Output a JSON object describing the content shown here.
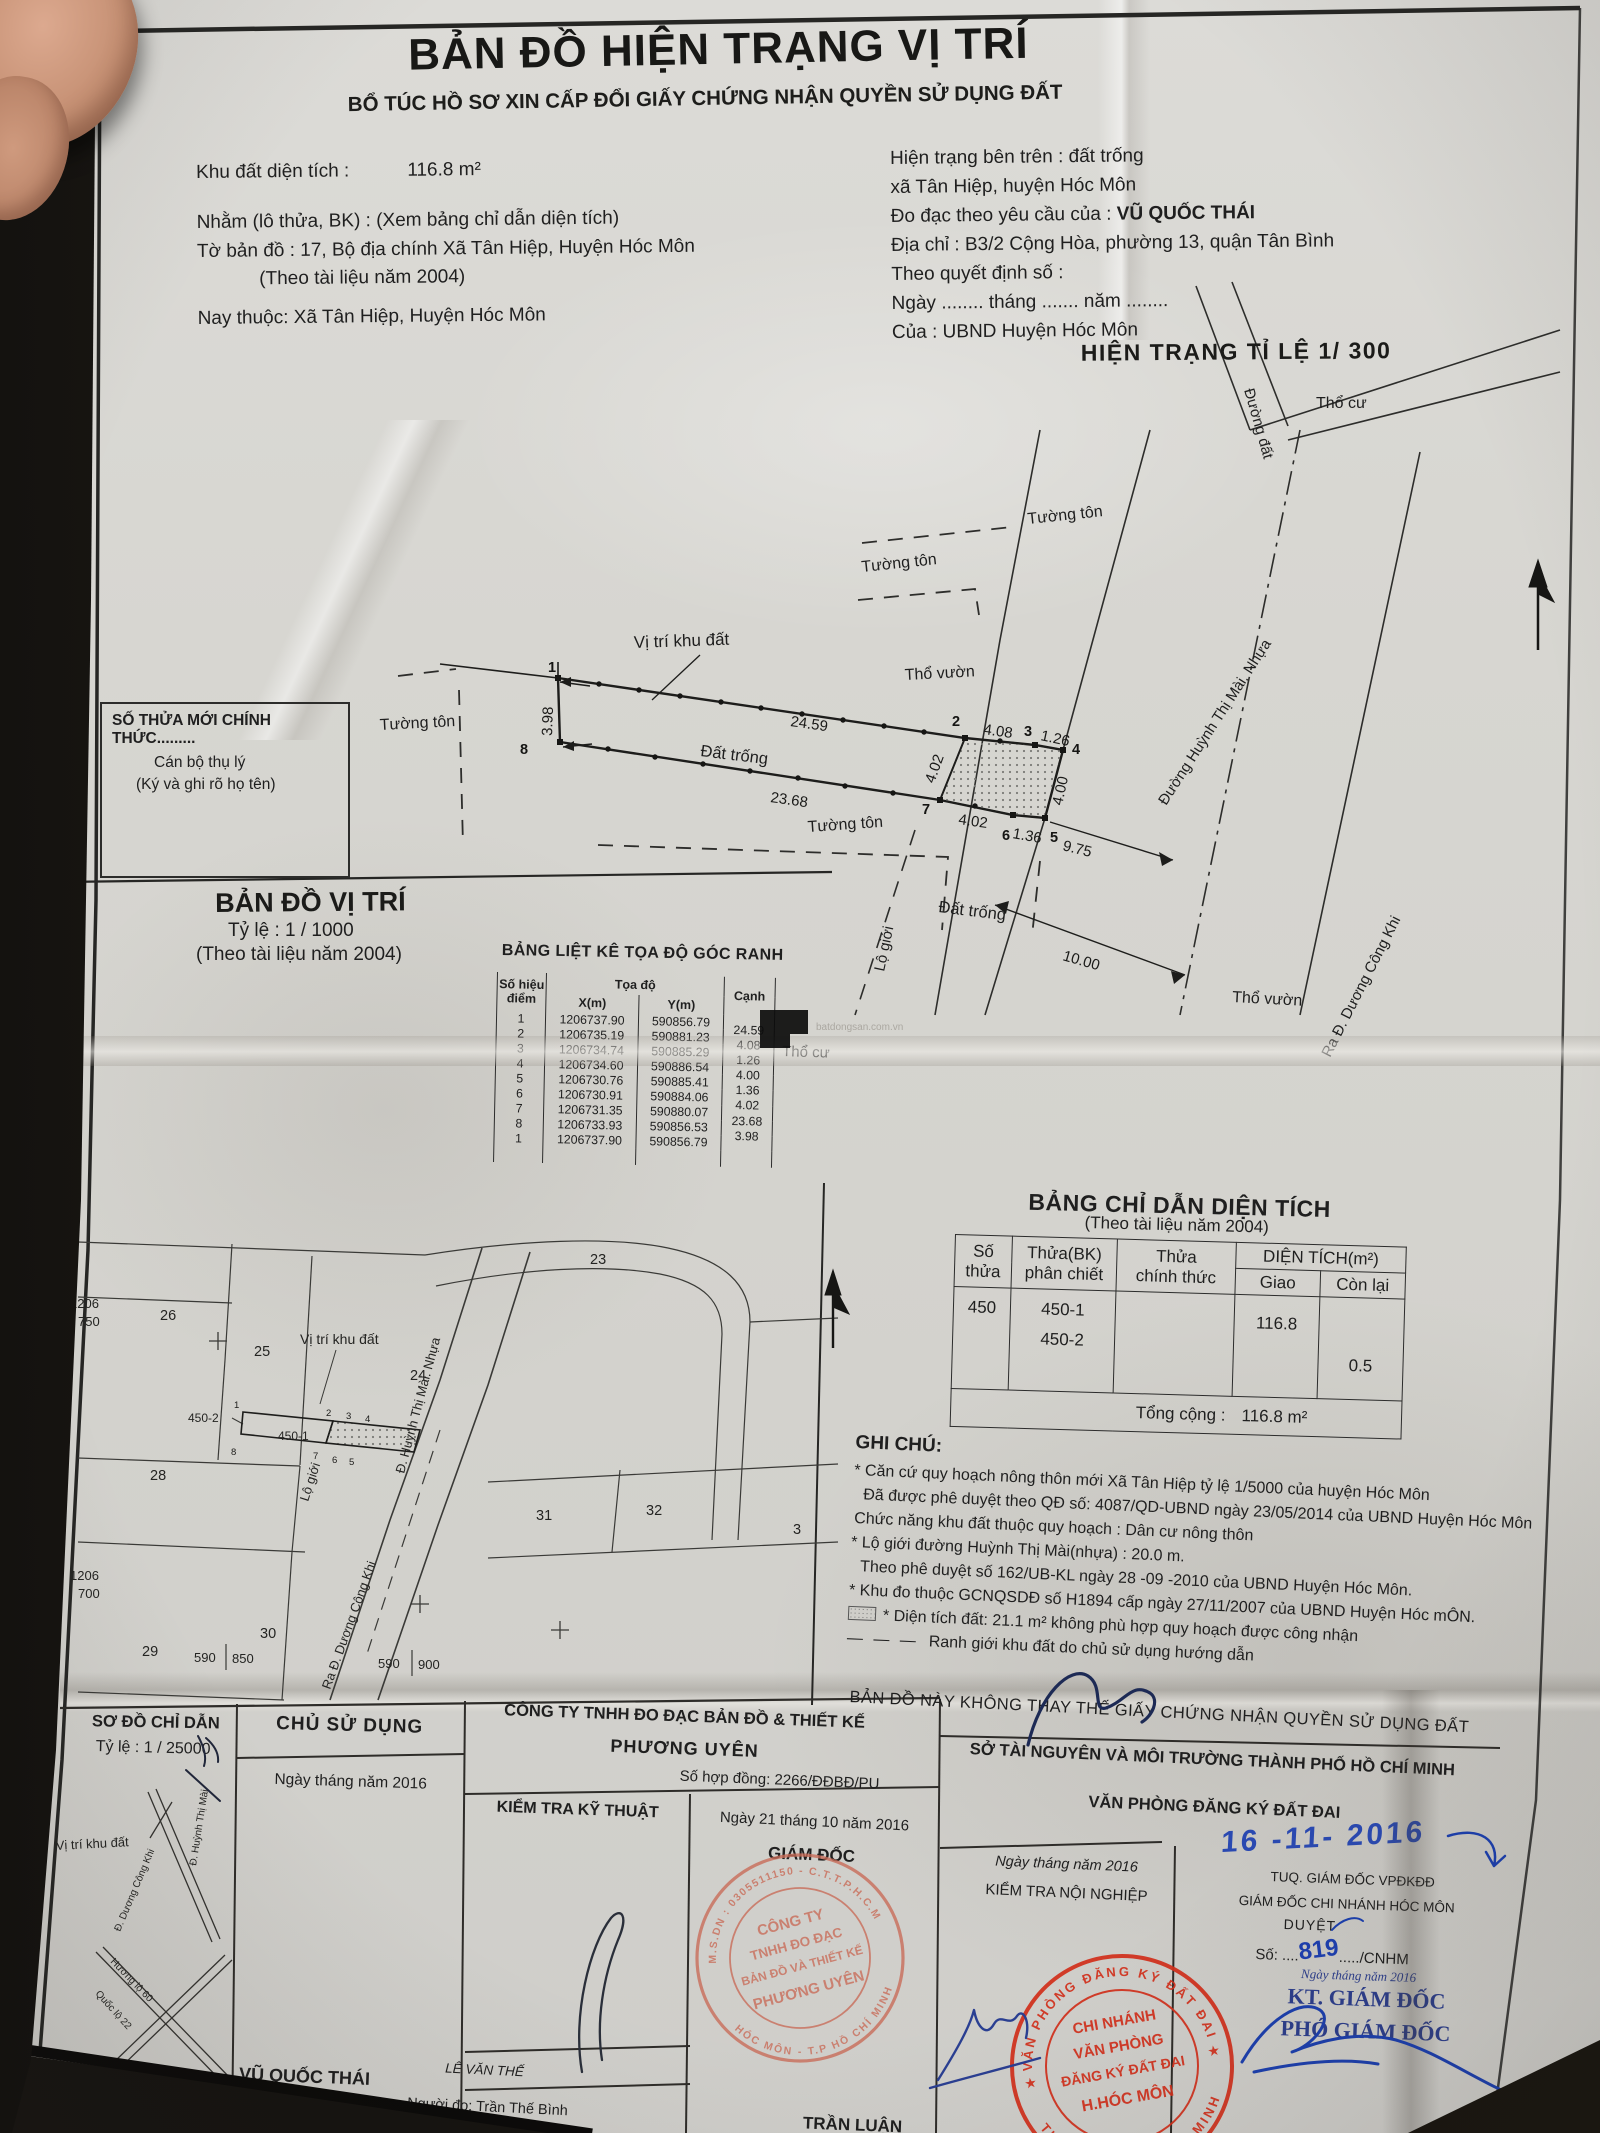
{
  "watermark": "batdongsan.com.vn",
  "header": {
    "title": "BẢN ĐỒ HIỆN TRẠNG VỊ TRÍ",
    "subtitle": "BỔ TÚC HỒ SƠ XIN CẤP ĐỔI GIẤY CHỨNG NHẬN QUYỀN SỬ DỤNG ĐẤT"
  },
  "info_left": {
    "area_label": "Khu đất diện tích :",
    "area_value": "116.8 m²",
    "lot_line": "Nhằm (lô thửa, BK) :  (Xem bảng chỉ dẫn diện tích)",
    "sheet_line": "Tờ bản đồ :  17, Bộ địa chính Xã Tân Hiệp, Huyện Hóc Môn",
    "doc_year": "(Theo tài liệu năm 2004)",
    "now_line": "Nay thuộc:  Xã Tân Hiệp, Huyện Hóc Môn"
  },
  "info_right": {
    "surface": "Hiện trạng bên trên : đất trống",
    "commune": "xã Tân Hiệp, huyện Hóc Môn",
    "request_label": "Đo đạc theo yêu cầu của :",
    "request_name": "VŨ QUỐC THÁI",
    "address": "Địa chỉ : B3/2 Cộng Hòa, phường 13, quận Tân Bình",
    "decision": "Theo quyết định số :",
    "date_blank": "Ngày ........ tháng ....... năm ........",
    "issuer": "Của : UBND Huyện Hóc Môn"
  },
  "site": {
    "title": "HIỆN TRẠNG TỈ LỆ 1/ 300",
    "vi_tri": "Vị trí khu đất",
    "dat_trong": "Đất trống",
    "tho_vuon": "Thổ vườn",
    "tho_cu": "Thổ cư",
    "duong_dat": "Đường đất",
    "tuong_ton": "Tường tôn",
    "lo_gioi": "Lộ giới",
    "street": "Đường Huỳnh Thị Mài. Nhựa",
    "ra_duong": "Ra Đ. Dương Công Khi",
    "d1": "24.59",
    "d2": "4.08",
    "d3": "1.26",
    "d4": "4.00",
    "d5": "1.36",
    "d6": "4.02",
    "d7": "23.68",
    "d8": "3.98",
    "d9": "4.02",
    "d10": "9.75",
    "d11": "10.00",
    "p1": "1",
    "p2": "2",
    "p3": "3",
    "p4": "4",
    "p5": "5",
    "p6": "6",
    "p7": "7",
    "p8": "8"
  },
  "official_box": {
    "line1": "SỐ THỬA MỚI CHÍNH THỨC.........",
    "line2": "Cán bộ thụ lý",
    "line3": "(Ký và ghi rõ họ tên)"
  },
  "loc": {
    "title": "BẢN ĐỒ VỊ TRÍ",
    "scale": "Tỷ lệ  :  1 /  1000",
    "source": "(Theo tài liệu năm 2004)",
    "vi_tri": "Vị trí khu đất",
    "p23": "23",
    "p24": "24",
    "p25": "25",
    "p26": "26",
    "p28": "28",
    "p29": "29",
    "p30": "30",
    "p31": "31",
    "p32": "32",
    "p3": "3",
    "p450_1": "450-1",
    "p450_2": "450-2",
    "n1206": "1206",
    "n750": "750",
    "n700": "700",
    "g590": "590",
    "g850": "850",
    "g900": "900",
    "lo_gioi": "Lộ giới",
    "street": "Đ. Huỳnh Thị Mài. Nhựa",
    "ra_duong": "Ra Đ. Dương Công Khi"
  },
  "coord_table": {
    "title": "BẢNG LIỆT KÊ TỌA ĐỘ GÓC RANH",
    "h_point1": "Số hiệu",
    "h_point2": "điểm",
    "h_coord": "Tọa độ",
    "h_x": "X(m)",
    "h_y": "Y(m)",
    "h_edge": "Cạnh",
    "rows": [
      {
        "p": "1",
        "x": "1206737.90",
        "y": "590856.79"
      },
      {
        "p": "2",
        "x": "1206735.19",
        "y": "590881.23"
      },
      {
        "p": "3",
        "x": "1206734.74",
        "y": "590885.29"
      },
      {
        "p": "4",
        "x": "1206734.60",
        "y": "590886.54"
      },
      {
        "p": "5",
        "x": "1206730.76",
        "y": "590885.41"
      },
      {
        "p": "6",
        "x": "1206730.91",
        "y": "590884.06"
      },
      {
        "p": "7",
        "x": "1206731.35",
        "y": "590880.07"
      },
      {
        "p": "8",
        "x": "1206733.93",
        "y": "590856.53"
      },
      {
        "p": "1",
        "x": "1206737.90",
        "y": "590856.79"
      }
    ],
    "edges": [
      "24.59",
      "4.08",
      "1.26",
      "4.00",
      "1.36",
      "4.02",
      "23.68",
      "3.98"
    ]
  },
  "area_table": {
    "title": "BẢNG CHỈ DẪN DIỆN TÍCH",
    "subtitle": "(Theo tài liệu năm 2004)",
    "h1a": "Số",
    "h1b": "thửa",
    "h2a": "Thửa(BK)",
    "h2b": "phân chiết",
    "h3a": "Thửa",
    "h3b": "chính thức",
    "h4": "DIỆN TÍCH(m²)",
    "h4a": "Giao",
    "h4b": "Còn lại",
    "so_thua": "450",
    "bk1": "450-1",
    "bk2": "450-2",
    "giao": "116.8",
    "con_lai": "0.5",
    "total_label": "Tổng cộng :",
    "total_value": "116.8 m²"
  },
  "notes": {
    "title": "GHI CHÚ:",
    "items": [
      "* Căn cứ quy hoạch nông thôn mới Xã Tân Hiệp tỷ lệ 1/5000 của huyện Hóc Môn",
      "Đã được phê duyệt theo QĐ số: 4087/QD-UBND ngày 23/05/2014 của UBND Huyện Hóc Môn",
      "Chức năng khu đất thuộc quy hoạch :  Dân cư nông thôn",
      "* Lộ giới đường Huỳnh Thị Mài(nhựa) : 20.0 m.",
      "Theo phê duyệt số 162/UB-KL  ngày 28 -09 -2010 của UBND Huyện Hóc Môn.",
      "* Khu đo thuộc GCNQSDĐ số  H1894 cấp ngày 27/11/2007 của UBND Huyện Hóc mÔN.",
      "* Diện tích đất: 21.1 m² không phù hợp quy hoạch  được công nhận",
      "Ranh giới khu đất do chủ sử dụng hướng dẫn"
    ],
    "disclaimer": "BẢN ĐỒ NÀY KHÔNG THAY THẾ GIẤY CHỨNG NHẬN QUYỀN SỬ DỤNG ĐẤT"
  },
  "legend": {
    "dash": "— — —"
  },
  "footer": {
    "sketch_title": "SƠ ĐỒ CHỈ DẪN",
    "sketch_scale": "Tỷ lệ  :  1 / 25000",
    "sk_vi_tri": "Vị trí khu đất",
    "sk_road1": "Đ. Dương Công Khi",
    "sk_road2": "Đ. Huỳnh Thị Mài",
    "sk_road3": "Hương lộ 60",
    "sk_road4": "Quốc lộ 22",
    "owner_header": "CHỦ SỬ DỤNG",
    "owner_date": "Ngày    tháng    năm 2016",
    "owner_name": "VŨ QUỐC THÁI",
    "company1": "CÔNG TY TNHH ĐO ĐẠC BẢN ĐỒ & THIẾT KẾ",
    "company2": "PHƯƠNG UYÊN",
    "contract": "Số hợp đồng: 2266/ĐĐBĐ/PU",
    "tech_check": "KIỂM TRA KỸ THUẬT",
    "dir_date": "Ngày 21 tháng 10 năm 2016",
    "dir_header": "GIÁM ĐỐC",
    "tech_name": "LÊ VĂN THẾ",
    "measurer": "Người đo: Trần Thế Bình",
    "dir_name": "TRẦN LUẬN",
    "dept1": "SỞ TÀI NGUYÊN VÀ MÔI TRƯỜNG THÀNH PHỐ HỒ CHÍ MINH",
    "dept2": "VĂN PHÒNG ĐĂNG KÝ ĐẤT ĐAI",
    "int_date": "Ngày    tháng    năm 2016",
    "int_check": "KIỂM TRA NỘI NGHIỆP",
    "hand_date": "16 -11- 2016",
    "tuq": "TUQ. GIÁM ĐỐC VPĐKĐĐ",
    "branch": "GIÁM ĐỐC CHI NHÁNH HÓC MÔN",
    "duyet": "DUYỆT",
    "so_pre": "Số: ....",
    "so_num": "819",
    "so_post": "...../CNHM",
    "kt_date": "Ngày     tháng      năm 2016",
    "kt": "KT. GIÁM ĐỐC",
    "deputy": "PHÓ GIÁM ĐỐC"
  },
  "stamps": {
    "company": {
      "ring_top": "M.S.DN : 0305511150 - C.T.T.P.H.C.M",
      "ring_bottom": "HÓC MÔN - T.P HỒ CHÍ MINH",
      "center1": "CÔNG TY",
      "center2": "TNHH ĐO ĐẠC",
      "center3": "BẢN ĐỒ VÀ THIẾT KẾ",
      "center4": "PHƯƠNG UYÊN"
    },
    "office": {
      "ring_top": "VĂN PHÒNG ĐĂNG KÝ ĐẤT ĐAI",
      "ring_bottom": "THÀNH PHỐ HỒ CHÍ MINH",
      "star": "★",
      "center1": "CHI NHÁNH",
      "center2": "VĂN PHÒNG",
      "center3": "ĐĂNG KÝ ĐẤT ĐAI",
      "center4": "H.HÓC MÔN"
    }
  }
}
